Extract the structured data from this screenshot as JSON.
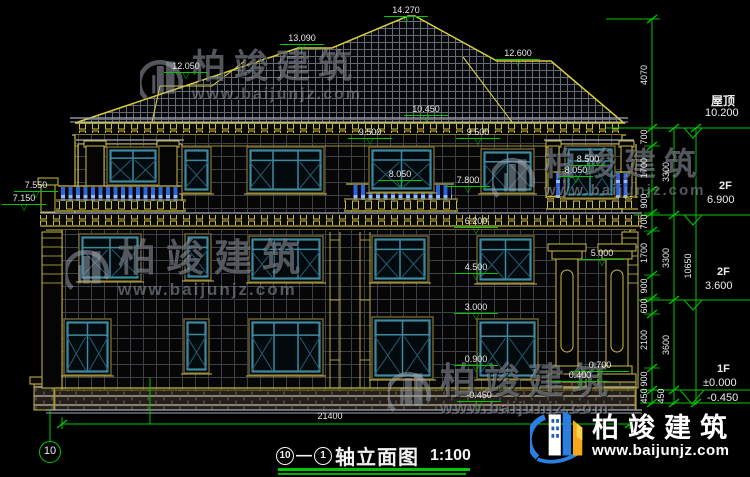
{
  "drawing": {
    "title": {
      "axis_start": "10",
      "axis_end": "1",
      "separator": "—",
      "name": "轴立面图",
      "scale": "1:100"
    },
    "grid_bubble": "10",
    "bottom_dimension": {
      "text": "21400",
      "x": 330,
      "y": 411
    },
    "levels_right": [
      {
        "name": "屋顶",
        "value": "10.200"
      },
      {
        "name": "2F",
        "value": "6.900"
      },
      {
        "name": "2F",
        "value": "3.600"
      },
      {
        "name": "1F",
        "value": "±0.000"
      },
      {
        "name": "",
        "value": "-0.450"
      }
    ],
    "elevation_marks": [
      {
        "text": "14.270",
        "x": 406,
        "y": 6
      },
      {
        "text": "13.090",
        "x": 302,
        "y": 34
      },
      {
        "text": "12.050",
        "x": 186,
        "y": 62
      },
      {
        "text": "12.600",
        "x": 518,
        "y": 49
      },
      {
        "text": "10.450",
        "x": 426,
        "y": 105
      },
      {
        "text": "9.500",
        "x": 370,
        "y": 128
      },
      {
        "text": "9.500",
        "x": 478,
        "y": 128
      },
      {
        "text": "8.050",
        "x": 400,
        "y": 170
      },
      {
        "text": "7.800",
        "x": 468,
        "y": 176
      },
      {
        "text": "8.500",
        "x": 588,
        "y": 155,
        "w": 34
      },
      {
        "text": "8.050",
        "x": 576,
        "y": 166,
        "w": 34
      },
      {
        "text": "7.550",
        "x": 36,
        "y": 181
      },
      {
        "text": "7.150",
        "x": 24,
        "y": 194
      },
      {
        "text": "6.200",
        "x": 476,
        "y": 217
      },
      {
        "text": "5.000",
        "x": 602,
        "y": 249
      },
      {
        "text": "4.500",
        "x": 476,
        "y": 263
      },
      {
        "text": "3.000",
        "x": 476,
        "y": 303
      },
      {
        "text": "0.900",
        "x": 476,
        "y": 355
      },
      {
        "text": "-0.450",
        "x": 479,
        "y": 391
      },
      {
        "text": "0.700",
        "x": 600,
        "y": 361,
        "w": 58
      },
      {
        "text": "0.400",
        "x": 580,
        "y": 371,
        "w": 58
      }
    ],
    "dimension_chain_labels": [
      {
        "text": "4070",
        "x": 644,
        "y": 75
      },
      {
        "text": "700",
        "x": 644,
        "y": 137
      },
      {
        "text": "1700",
        "x": 644,
        "y": 168
      },
      {
        "text": "900",
        "x": 644,
        "y": 201
      },
      {
        "text": "700",
        "x": 644,
        "y": 222
      },
      {
        "text": "1700",
        "x": 644,
        "y": 253
      },
      {
        "text": "900",
        "x": 644,
        "y": 286
      },
      {
        "text": "600",
        "x": 644,
        "y": 306
      },
      {
        "text": "2100",
        "x": 644,
        "y": 340
      },
      {
        "text": "900",
        "x": 644,
        "y": 379
      },
      {
        "text": "450",
        "x": 644,
        "y": 396
      },
      {
        "text": "3300",
        "x": 666,
        "y": 172
      },
      {
        "text": "3300",
        "x": 666,
        "y": 258
      },
      {
        "text": "3600",
        "x": 666,
        "y": 345
      },
      {
        "text": "450",
        "x": 661,
        "y": 396
      },
      {
        "text": "10650",
        "x": 688,
        "y": 266
      }
    ],
    "colors": {
      "dimension_green": "#00c800",
      "line_khaki": "#c9bb45",
      "roof_outline": "#d8ce3c",
      "window_teal": "#3d8aa0",
      "baluster_blue": "#2e62d8",
      "logo_blue": "#2b7fe0",
      "logo_orange": "#f5a81c"
    }
  },
  "watermark": {
    "brand": "柏竣建筑",
    "url": "www.baijunjz.com"
  }
}
